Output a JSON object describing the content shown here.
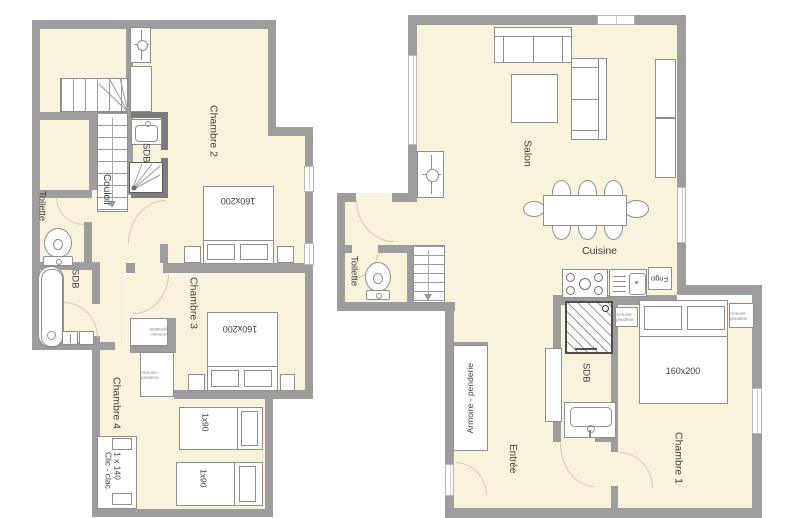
{
  "meta": {
    "type": "apartment floor plan, two levels"
  },
  "colors": {
    "wall": "#9d9d9d",
    "floor": "#faf3dc",
    "furniture_outline": "#8e8e8e",
    "shower_border": "#4f4f4f"
  },
  "left": {
    "chambre2": "Chambre 2",
    "chambre3": "Chambre 3",
    "chambre4": "Chambre 4",
    "couloir": "Couloir",
    "toilette": "Toilette",
    "sdb_upper": "SDB",
    "sdb_lower": "SDB",
    "bed2_size": "160x200",
    "bed3_size": "160x200",
    "single1_size": "1x90",
    "single2_size": "1x90",
    "clic_clac_l1": "Clic - clac",
    "clic_clac_l2": "1 x 140",
    "armoire1": "Armoire - penderie",
    "armoire2": "Armoire - penderie"
  },
  "right": {
    "salon": "Salon",
    "cuisine": "Cuisine",
    "toilette": "Toilette",
    "entree": "Entrée",
    "sdb": "SDB",
    "chambre1": "Chambre 1",
    "frigo": "Frigo",
    "bed1_size": "160x200",
    "armoire": "Armoire - penderie",
    "chevet_left": "Armoire - penderie",
    "chevet_right": "Armoire - penderie"
  }
}
